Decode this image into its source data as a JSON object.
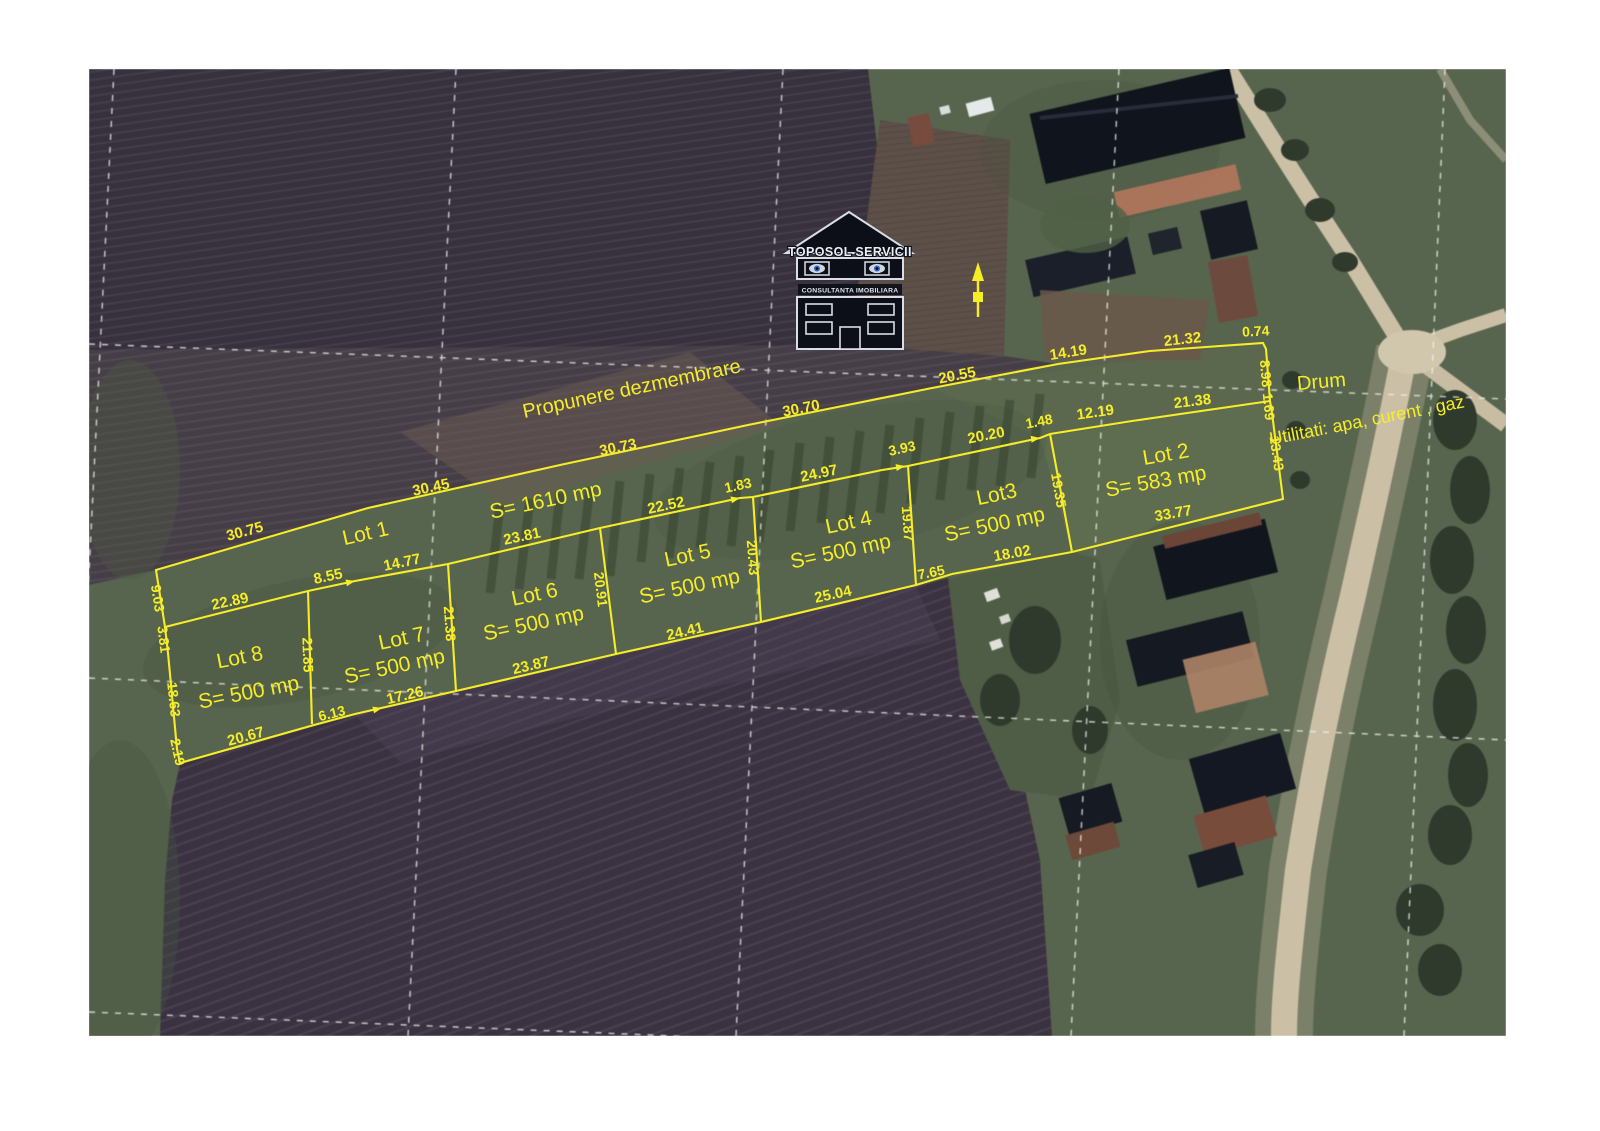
{
  "map": {
    "kind": "satellite-photo-with-cadastral-overlay",
    "palette": {
      "overlay_yellow": "#f6ed28",
      "grid_white": "#f5f3ee",
      "field_dark": "#37303e",
      "field_mid": "#463e46",
      "field_tan": "#5e5048",
      "grass": "#57654c",
      "road": "#ccc0a4",
      "building_dark": "#11151f",
      "roof_rust": "#7a4a3a"
    }
  },
  "logo": {
    "title": "TOPOSOL SERVICII",
    "subtitle": "CONSULTANTA IMOBILIARA"
  },
  "annotations": {
    "proposal_title": "Propunere dezmembrare",
    "road_label": "Drum",
    "utilities_label": "Utilitati: apa, curent , gaz"
  },
  "lots": [
    {
      "name": "Lot 1",
      "area_label": "S= 1610 mp"
    },
    {
      "name": "Lot 2",
      "area_label": "S= 583 mp"
    },
    {
      "name": "Lot3",
      "area_label": "S= 500 mp"
    },
    {
      "name": "Lot 4",
      "area_label": "S= 500 mp"
    },
    {
      "name": "Lot 5",
      "area_label": "S= 500 mp"
    },
    {
      "name": "Lot 6",
      "area_label": "S= 500 mp"
    },
    {
      "name": "Lot 7",
      "area_label": "S= 500 mp"
    },
    {
      "name": "Lot 8",
      "area_label": "S= 500 mp"
    }
  ],
  "overlay": {
    "color": "#f6ed28",
    "labels": [
      {
        "t": "30.75",
        "x": 246,
        "y": 536,
        "r": -15,
        "s": 15,
        "k": "dim"
      },
      {
        "t": "30.45",
        "x": 432,
        "y": 492,
        "r": -12,
        "s": 15,
        "k": "dim"
      },
      {
        "t": "30.73",
        "x": 619,
        "y": 452,
        "r": -12,
        "s": 15,
        "k": "dim"
      },
      {
        "t": "30.70",
        "x": 802,
        "y": 413,
        "r": -11,
        "s": 15,
        "k": "dim"
      },
      {
        "t": "20.55",
        "x": 958,
        "y": 380,
        "r": -11,
        "s": 15,
        "k": "dim"
      },
      {
        "t": "14.19",
        "x": 1069,
        "y": 357,
        "r": -9,
        "s": 15,
        "k": "dim"
      },
      {
        "t": "21.32",
        "x": 1183,
        "y": 344,
        "r": -6,
        "s": 15,
        "k": "dim"
      },
      {
        "t": "0.74",
        "x": 1256,
        "y": 336,
        "r": -3,
        "s": 14,
        "k": "dim"
      },
      {
        "t": "8.98",
        "x": 1261,
        "y": 374,
        "r": 85,
        "s": 14,
        "k": "dim"
      },
      {
        "t": "1.69",
        "x": 1264,
        "y": 407,
        "r": 85,
        "s": 14,
        "k": "dim"
      },
      {
        "t": "13.43",
        "x": 1272,
        "y": 454,
        "r": 82,
        "s": 14,
        "k": "dim"
      },
      {
        "t": "9.03",
        "x": 153,
        "y": 599,
        "r": 81,
        "s": 14,
        "k": "dim"
      },
      {
        "t": "3.81",
        "x": 159,
        "y": 640,
        "r": 83,
        "s": 14,
        "k": "dim"
      },
      {
        "t": "18.63",
        "x": 169,
        "y": 700,
        "r": 84,
        "s": 14,
        "k": "dim"
      },
      {
        "t": "2.19",
        "x": 173,
        "y": 753,
        "r": 78,
        "s": 14,
        "k": "dim"
      },
      {
        "t": "22.89",
        "x": 231,
        "y": 606,
        "r": -12,
        "s": 15,
        "k": "dim"
      },
      {
        "t": "8.55",
        "x": 329,
        "y": 581,
        "r": -12,
        "s": 15,
        "k": "dim"
      },
      {
        "t": "14.77",
        "x": 403,
        "y": 567,
        "r": -12,
        "s": 15,
        "k": "dim"
      },
      {
        "t": "23.81",
        "x": 523,
        "y": 541,
        "r": -12,
        "s": 15,
        "k": "dim"
      },
      {
        "t": "22.52",
        "x": 667,
        "y": 510,
        "r": -12,
        "s": 15,
        "k": "dim"
      },
      {
        "t": "1.83",
        "x": 739,
        "y": 490,
        "r": -12,
        "s": 14,
        "k": "dim"
      },
      {
        "t": "24.97",
        "x": 820,
        "y": 478,
        "r": -12,
        "s": 15,
        "k": "dim"
      },
      {
        "t": "3.93",
        "x": 903,
        "y": 453,
        "r": -12,
        "s": 14,
        "k": "dim"
      },
      {
        "t": "20.20",
        "x": 987,
        "y": 440,
        "r": -11,
        "s": 15,
        "k": "dim"
      },
      {
        "t": "1.48",
        "x": 1040,
        "y": 426,
        "r": -11,
        "s": 14,
        "k": "dim"
      },
      {
        "t": "12.19",
        "x": 1096,
        "y": 417,
        "r": -8,
        "s": 15,
        "k": "dim"
      },
      {
        "t": "21.38",
        "x": 1193,
        "y": 406,
        "r": -7,
        "s": 15,
        "k": "dim"
      },
      {
        "t": "21.85",
        "x": 303,
        "y": 655,
        "r": 88,
        "s": 14,
        "k": "dim"
      },
      {
        "t": "21.38",
        "x": 445,
        "y": 624,
        "r": 86,
        "s": 14,
        "k": "dim"
      },
      {
        "t": "20.91",
        "x": 596,
        "y": 590,
        "r": 83,
        "s": 14,
        "k": "dim"
      },
      {
        "t": "20.43",
        "x": 748,
        "y": 558,
        "r": 86,
        "s": 14,
        "k": "dim"
      },
      {
        "t": "19.87",
        "x": 903,
        "y": 524,
        "r": 86,
        "s": 14,
        "k": "dim"
      },
      {
        "t": "19.35",
        "x": 1054,
        "y": 491,
        "r": 80,
        "s": 14,
        "k": "dim"
      },
      {
        "t": "20.67",
        "x": 247,
        "y": 741,
        "r": -15,
        "s": 15,
        "k": "dim"
      },
      {
        "t": "6.13",
        "x": 333,
        "y": 718,
        "r": -14,
        "s": 14,
        "k": "dim"
      },
      {
        "t": "17.26",
        "x": 406,
        "y": 700,
        "r": -13,
        "s": 15,
        "k": "dim"
      },
      {
        "t": "23.87",
        "x": 532,
        "y": 670,
        "r": -13,
        "s": 15,
        "k": "dim"
      },
      {
        "t": "24.41",
        "x": 686,
        "y": 636,
        "r": -13,
        "s": 15,
        "k": "dim"
      },
      {
        "t": "25.04",
        "x": 834,
        "y": 599,
        "r": -12,
        "s": 15,
        "k": "dim"
      },
      {
        "t": "7.65",
        "x": 932,
        "y": 577,
        "r": -11,
        "s": 14,
        "k": "dim"
      },
      {
        "t": "18.02",
        "x": 1013,
        "y": 558,
        "r": -10,
        "s": 15,
        "k": "dim"
      },
      {
        "t": "33.77",
        "x": 1174,
        "y": 518,
        "r": -10,
        "s": 15,
        "k": "dim"
      },
      {
        "t": "Lot 1",
        "x": 367,
        "y": 540,
        "r": -13,
        "s": 21,
        "k": "lot"
      },
      {
        "t": "S= 1610 mp",
        "x": 547,
        "y": 507,
        "r": -12,
        "s": 21,
        "k": "lot"
      },
      {
        "t": "Lot 8",
        "x": 241,
        "y": 664,
        "r": -11,
        "s": 21,
        "k": "lot"
      },
      {
        "t": "S= 500 mp",
        "x": 250,
        "y": 699,
        "r": -11,
        "s": 21,
        "k": "lot"
      },
      {
        "t": "Lot 7",
        "x": 403,
        "y": 645,
        "r": -12,
        "s": 21,
        "k": "lot"
      },
      {
        "t": "S= 500 mp",
        "x": 396,
        "y": 673,
        "r": -12,
        "s": 21,
        "k": "lot"
      },
      {
        "t": "Lot 6",
        "x": 536,
        "y": 601,
        "r": -12,
        "s": 21,
        "k": "lot"
      },
      {
        "t": "S= 500 mp",
        "x": 535,
        "y": 630,
        "r": -12,
        "s": 21,
        "k": "lot"
      },
      {
        "t": "Lot 5",
        "x": 689,
        "y": 562,
        "r": -12,
        "s": 21,
        "k": "lot"
      },
      {
        "t": "S= 500 mp",
        "x": 691,
        "y": 593,
        "r": -12,
        "s": 21,
        "k": "lot"
      },
      {
        "t": "Lot 4",
        "x": 850,
        "y": 529,
        "r": -12,
        "s": 21,
        "k": "lot"
      },
      {
        "t": "S= 500 mp",
        "x": 842,
        "y": 558,
        "r": -12,
        "s": 21,
        "k": "lot"
      },
      {
        "t": "Lot3",
        "x": 998,
        "y": 501,
        "r": -12,
        "s": 21,
        "k": "lot"
      },
      {
        "t": "S= 500 mp",
        "x": 996,
        "y": 531,
        "r": -12,
        "s": 21,
        "k": "lot"
      },
      {
        "t": "Lot 2",
        "x": 1167,
        "y": 461,
        "r": -10,
        "s": 21,
        "k": "lot"
      },
      {
        "t": "S= 583 mp",
        "x": 1157,
        "y": 488,
        "r": -10,
        "s": 21,
        "k": "lot"
      },
      {
        "t": "Propunere dezmembrare",
        "x": 633,
        "y": 395,
        "r": -12,
        "s": 20,
        "k": "note"
      },
      {
        "t": "Drum",
        "x": 1322,
        "y": 388,
        "r": -5,
        "s": 20,
        "k": "note"
      },
      {
        "t": "Utilitati: apa, curent , gaz",
        "x": 1368,
        "y": 426,
        "r": -11,
        "s": 18,
        "k": "note"
      }
    ]
  }
}
